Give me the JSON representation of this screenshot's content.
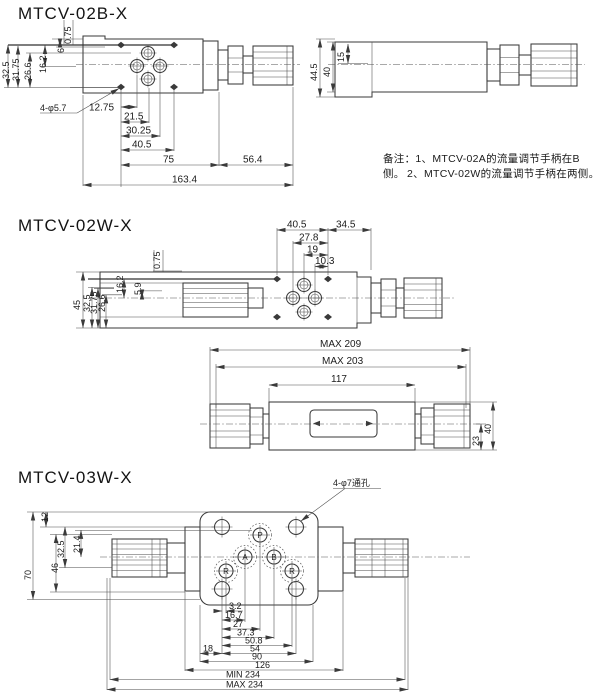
{
  "colors": {
    "line": "#3a3a3a",
    "text": "#1c1c1c",
    "background": "#ffffff"
  },
  "fig1": {
    "title": "MTCV-02B-X",
    "dims_left": [
      "32.5",
      "31.75",
      "26.6",
      "16.2",
      "6",
      "0.75"
    ],
    "hole_callout": "4-φ5.7",
    "dims_bottom": [
      "12.75",
      "21.5",
      "30.25",
      "40.5",
      "75",
      "56.4",
      "163.4"
    ],
    "dims_side": [
      "44.5",
      "40",
      "15"
    ],
    "notes": {
      "line1": "备注：1、MTCV-02A的流量调节手柄在B侧。",
      "line2": "2、MTCV-02W的流量调节手柄在两侧。"
    }
  },
  "fig2": {
    "title": "MTCV-02W-X",
    "dims_left": [
      "45",
      "32.5",
      "31.75",
      "26.6",
      "16.2",
      "5.9",
      "0.75"
    ],
    "dims_top": [
      "40.5",
      "34.5",
      "27.8",
      "19",
      "10.3"
    ],
    "dims_length": [
      "MAX 209",
      "MAX 203",
      "117"
    ],
    "dims_right": [
      "23",
      "40"
    ]
  },
  "fig3": {
    "title": "MTCV-03W-X",
    "dims_left": [
      "12",
      "32.5",
      "21.4",
      "70",
      "46"
    ],
    "hole_callout": "4-φ7通孔",
    "ports": [
      "P",
      "A",
      "B",
      "R",
      "R"
    ],
    "dims_bottom": [
      "3.2",
      "16.7",
      "27",
      "37.3",
      "50.8",
      "18",
      "54",
      "90",
      "126",
      "MIN 234",
      "MAX 234"
    ]
  }
}
